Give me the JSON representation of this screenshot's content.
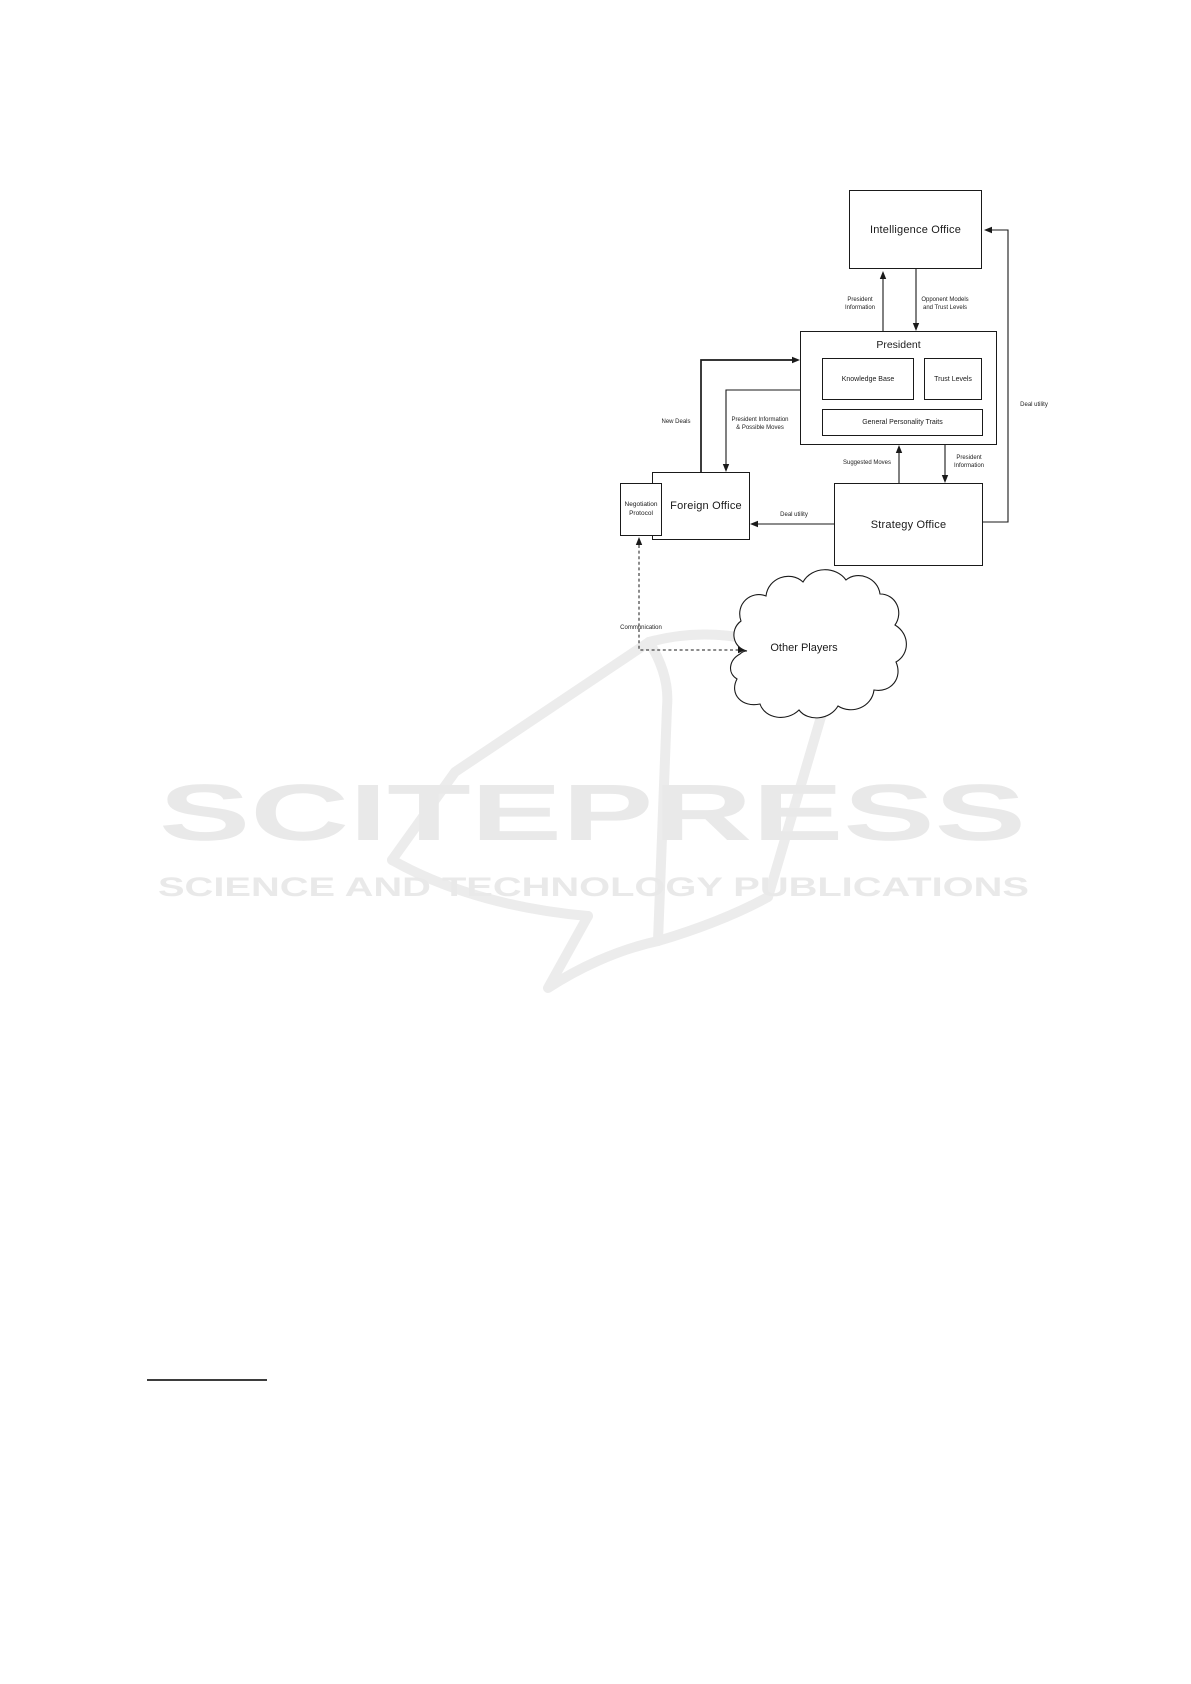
{
  "diagram": {
    "nodes": {
      "intelligence_office": {
        "label": "Intelligence Office"
      },
      "president": {
        "label": "President"
      },
      "knowledge_base": {
        "label": "Knowledge Base"
      },
      "trust_levels": {
        "label": "Trust Levels"
      },
      "general_personality_traits": {
        "label": "General Personality Traits"
      },
      "foreign_office": {
        "label": "Foreign Office"
      },
      "negotiation_protocol": {
        "label": "Negotiation\nProtocol"
      },
      "strategy_office": {
        "label": "Strategy Office"
      },
      "other_players": {
        "label": "Other Players"
      }
    },
    "edges": {
      "president_information_to_intelligence": {
        "label": "President\nInformation"
      },
      "opponent_models_and_trust_levels": {
        "label": "Opponent Models\nand Trust Levels"
      },
      "new_deals": {
        "label": "New Deals"
      },
      "president_information_possible_moves": {
        "label": "President Information\n& Possible Moves"
      },
      "suggested_moves": {
        "label": "Suggested Moves"
      },
      "president_information_to_strategy": {
        "label": "President\nInformation"
      },
      "deal_utility_to_foreign_office": {
        "label": "Deal utility"
      },
      "deal_utility_to_intelligence": {
        "label": "Deal utility"
      },
      "communication": {
        "label": "Communication"
      }
    },
    "line_color": "#1a1a1a"
  },
  "watermark": {
    "wordmark": "SCITEPRESS",
    "tagline": "SCIENCE AND TECHNOLOGY PUBLICATIONS",
    "text_color": "#e9e9e9",
    "book_color": "#ececec"
  }
}
